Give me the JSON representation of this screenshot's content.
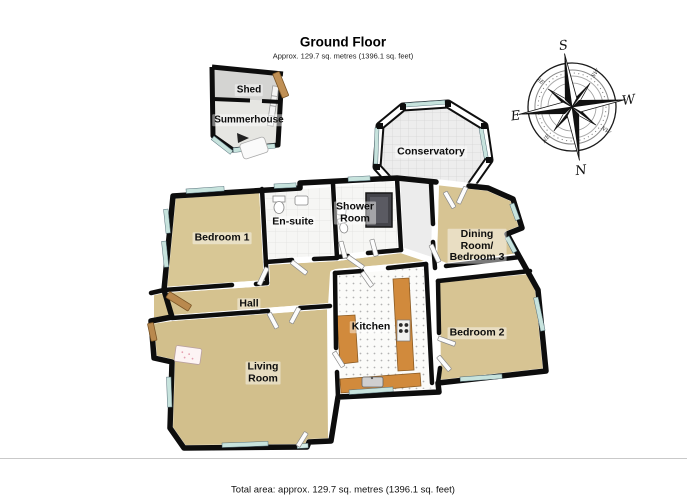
{
  "header": {
    "title": "Ground Floor",
    "subtitle": "Approx. 129.7 sq. metres (1396.1 sq. feet)"
  },
  "footer": {
    "total_area": "Total area: approx. 129.7 sq. metres (1396.1 sq. feet)"
  },
  "rooms": {
    "shed": {
      "label": "Shed"
    },
    "summerhouse": {
      "label": "Summerhouse"
    },
    "conservatory": {
      "label": "Conservatory"
    },
    "bedroom1": {
      "label": "Bedroom 1"
    },
    "ensuite": {
      "label": "En-suite"
    },
    "shower": {
      "line1": "Shower",
      "line2": "Room"
    },
    "dining": {
      "line1": "Dining",
      "line2": "Room/",
      "line3": "Bedroom 3"
    },
    "hall": {
      "label": "Hall"
    },
    "kitchen": {
      "label": "Kitchen"
    },
    "bedroom2": {
      "label": "Bedroom 2"
    },
    "living": {
      "line1": "Living",
      "line2": "Room"
    }
  },
  "compass": {
    "n": "N",
    "s": "S",
    "e": "E",
    "w": "W",
    "ne": "NE",
    "nw": "NW",
    "se": "SE",
    "sw": "SW"
  },
  "colors": {
    "carpet": "#d5c28f",
    "wall": "#111111",
    "glazing": "#c7e3dd",
    "counter": "#d18a3c",
    "conservatory_floor": "#ededed",
    "wood": "#b9894e"
  }
}
